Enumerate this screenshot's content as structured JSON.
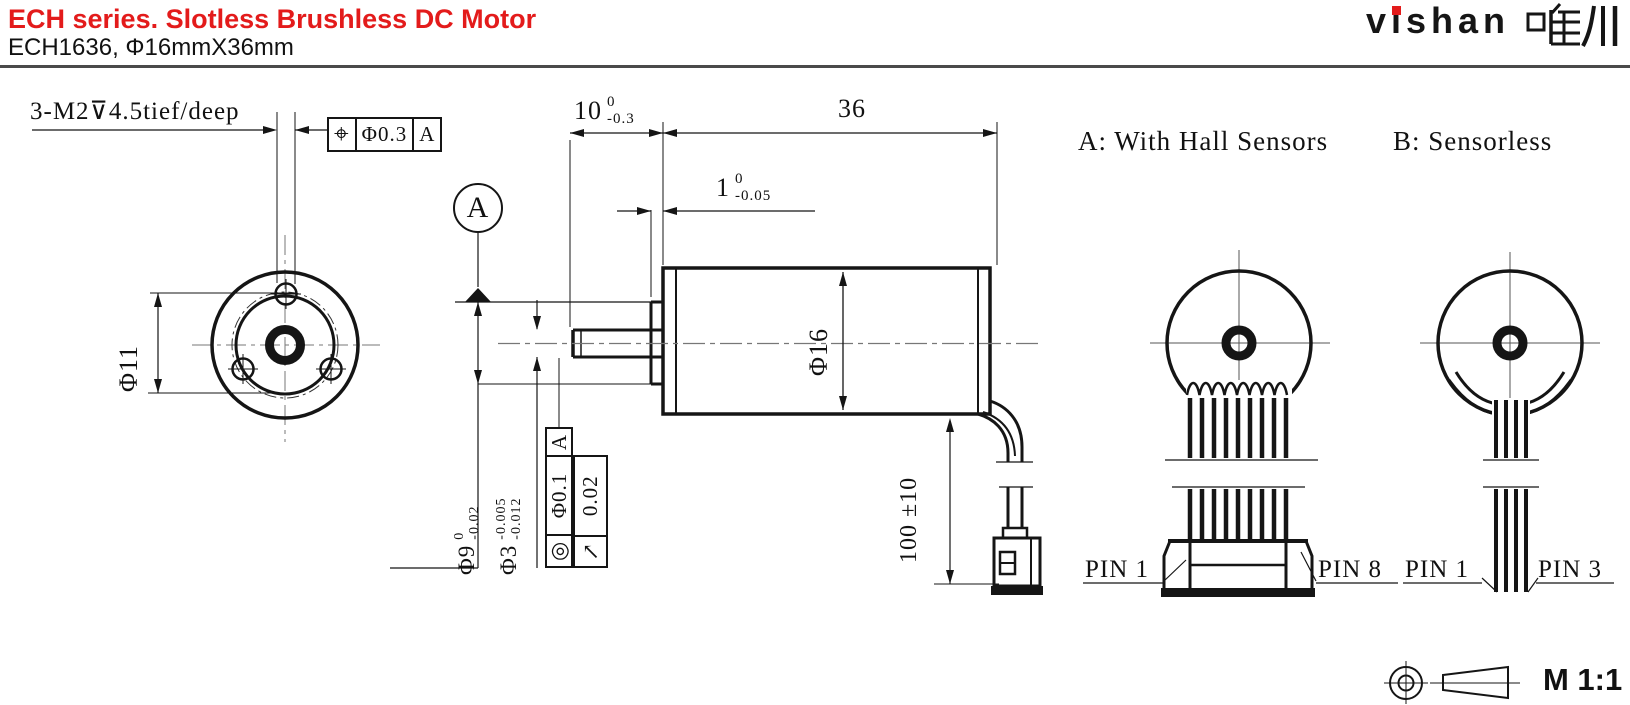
{
  "header": {
    "title": "ECH series. Slotless Brushless DC Motor",
    "subtitle": "ECH1636, Φ16mmX36mm",
    "logo_latin": "vishan",
    "logo_cjk": "唯川"
  },
  "annotations": {
    "tap_note": "3-M2⊽4.5tief/deep",
    "position_frame": {
      "symbol": "⌖",
      "tolerance": "Φ0.3",
      "datum": "A"
    },
    "datum_balloon": "A",
    "dim_shaft_length": {
      "value": "10",
      "upper": "0",
      "lower": "-0.3"
    },
    "dim_body_length": "36",
    "dim_boss_length": {
      "value": "1",
      "upper": "0",
      "lower": "-0.05"
    },
    "dim_bolt_circle": "Φ11",
    "dim_body_diameter": "Φ16",
    "dim_boss_diameter": {
      "value": "Φ9",
      "upper": "0",
      "lower": "-0.02"
    },
    "dim_shaft_diameter": {
      "value": "Φ3",
      "upper": "-0.005",
      "lower": "-0.012"
    },
    "concentricity_frame": {
      "symbol": "◎",
      "tolerance": "Φ0.1",
      "datum": "A"
    },
    "runout_frame": {
      "symbol": "↗",
      "tolerance": "0.02"
    },
    "dim_cable_length": "100 ±10"
  },
  "variants": {
    "a_label": "A: With Hall Sensors",
    "b_label": "B: Sensorless",
    "a_pin_first": "PIN 1",
    "a_pin_last": "PIN 8",
    "b_pin_first": "PIN 1",
    "b_pin_last": "PIN 3"
  },
  "footer": {
    "scale": "M 1:1"
  }
}
